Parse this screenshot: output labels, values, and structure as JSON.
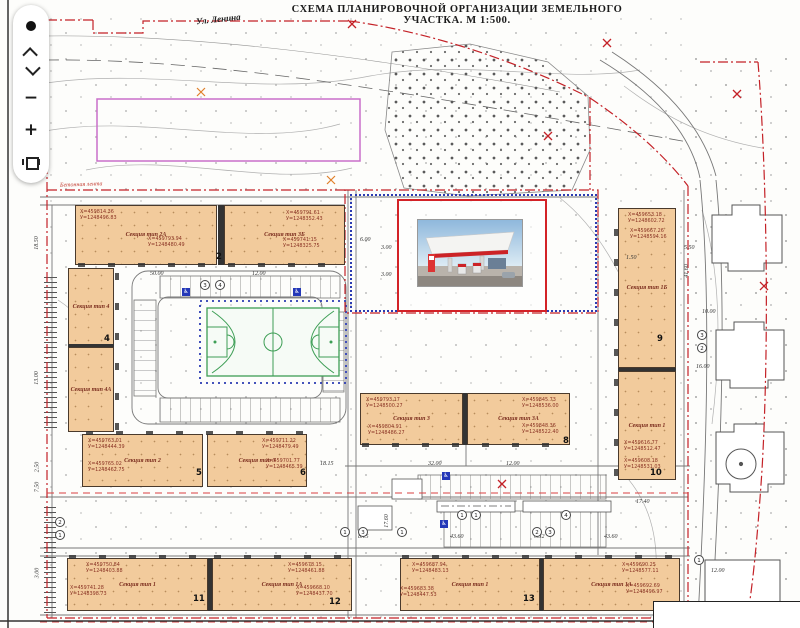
{
  "header": {
    "title": "СХЕМА ПЛАНИРОВОЧНОЙ ОРГАНИЗАЦИИ ЗЕМЕЛЬНОГО УЧАСТКА.  М 1:500."
  },
  "toolbar": {
    "buttons": [
      {
        "name": "marker-dot"
      },
      {
        "name": "pan-up"
      },
      {
        "name": "pan-down"
      },
      {
        "name": "zoom-out",
        "glyph": "−"
      },
      {
        "name": "zoom-in",
        "glyph": "+"
      },
      {
        "name": "print"
      }
    ]
  },
  "map": {
    "street_label": "Ул. Ленина",
    "boundary_label": "Бетонная лента",
    "accessibility_glyph": "♿",
    "colors": {
      "building_fill": "#f2cb9c",
      "boundary_red": "#c42127",
      "fence_blue": "#2b3bb2",
      "court_green": "#3d9e55",
      "planned_area_magenta": "#c96fc9"
    },
    "buildings": [
      {
        "label": "Секция тип 2А"
      },
      {
        "label": "Секция тип 3Б"
      },
      {
        "label": "Секция тип 4"
      },
      {
        "label": "Секция тип 4А"
      },
      {
        "label": "Секция тип 2"
      },
      {
        "label": "Секция тип 3"
      },
      {
        "label": "Секция тип 3"
      },
      {
        "label": "Секция тип 3А"
      },
      {
        "label": "Секция тип 1Б"
      },
      {
        "label": "Секция тип 1"
      },
      {
        "label": "Секция тип 1"
      },
      {
        "label": "Секция тип 1А"
      },
      {
        "label": "Секция тип 1"
      },
      {
        "label": "Секция тип 1А"
      }
    ],
    "plan_numbers": [
      "2",
      "4",
      "5",
      "6",
      "8",
      "9",
      "10",
      "11",
      "12",
      "13"
    ],
    "coord_labels": [
      {
        "x": "Х=459814.36",
        "y": "У=1248496.83"
      },
      {
        "x": "Х=459793.94",
        "y": "У=1248480.49"
      },
      {
        "x": "Х=459791.61",
        "y": "У=1248352.43"
      },
      {
        "x": "Х=459741.15",
        "y": "У=1248325.75"
      },
      {
        "x": "Х=459763.01",
        "y": "У=1248444.39"
      },
      {
        "x": "Х=459765.02",
        "y": "У=1248462.75"
      },
      {
        "x": "Х=459711.22",
        "y": "У=1248479.49"
      },
      {
        "x": "Х=459701.77",
        "y": "У=1248465.39"
      },
      {
        "x": "Х=459793.17",
        "y": "У=1248500.27"
      },
      {
        "x": "Х=459804.91",
        "y": "У=1248486.27"
      },
      {
        "x": "Х=459845.73",
        "y": "У=1248536.00"
      },
      {
        "x": "Х=459848.36",
        "y": "У=1248522.40"
      },
      {
        "x": "Х=459653.18",
        "y": "У=1248602.72"
      },
      {
        "x": "Х=459667.26",
        "y": "У=1248594.16"
      },
      {
        "x": "Х=459616.77",
        "y": "У=1248512.47"
      },
      {
        "x": "Х=459608.18",
        "y": "У=1248531.03"
      },
      {
        "x": "Х=459750.84",
        "y": "У=1248403.88"
      },
      {
        "x": "Х=459741.28",
        "y": "У=1248398.73"
      },
      {
        "x": "Х=459678.15",
        "y": "У=1248461.88"
      },
      {
        "x": "Х=459668.10",
        "y": "У=1248437.70"
      },
      {
        "x": "Х=459687.94",
        "y": "У=1248483.13"
      },
      {
        "x": "Х=459683.38",
        "y": "У=1248447.53"
      },
      {
        "x": "Х=459690.25",
        "y": "У=1248577.11"
      },
      {
        "x": "Х=459692.69",
        "y": "У=1248496.97"
      }
    ],
    "dims": [
      "50.00",
      "12.00",
      "6.00",
      "3.00",
      "3.00",
      "32.00",
      "12.00",
      "18.15",
      "43.60",
      "0.32",
      "43.60",
      "8.15",
      "17.60",
      "17.40",
      "41.60",
      "10.00",
      "1.50",
      "5.50",
      "12.00",
      "16.00",
      "18.50",
      "13.00",
      "2.50",
      "7.50",
      "3.00"
    ],
    "circled_numbers": [
      "3",
      "4",
      "1",
      "1",
      "4",
      "1",
      "3",
      "1",
      "2",
      "3",
      "3",
      "2",
      "1",
      "2",
      "1"
    ]
  }
}
